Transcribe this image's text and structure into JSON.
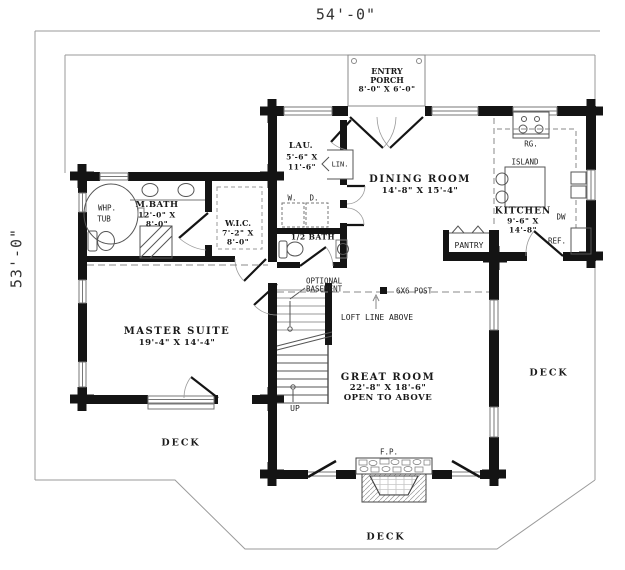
{
  "dimensions": {
    "top": "54'-0\"",
    "left": "53'-0\""
  },
  "rooms": {
    "entry_porch": {
      "line1": "ENTRY",
      "line2": "PORCH",
      "size": "8'-0\" X 6'-0\""
    },
    "laundry": {
      "name": "LAU.",
      "size1": "5'-6\" X",
      "size2": "11'-6\""
    },
    "dining_room": {
      "name": "DINING ROOM",
      "size": "14'-8\" X 15'-4\""
    },
    "kitchen": {
      "name": "KITCHEN",
      "size1": "9'-6\" X",
      "size2": "14'-8\""
    },
    "master_bath": {
      "name": "M.BATH",
      "size1": "12'-0\" X",
      "size2": "8'-0\""
    },
    "wic": {
      "name": "W.I.C.",
      "size1": "7'-2\" X",
      "size2": "8'-0\""
    },
    "half_bath": {
      "name": "1/2 BATH"
    },
    "master_suite": {
      "name": "MASTER SUITE",
      "size": "19'-4\" X 14'-4\""
    },
    "great_room": {
      "name": "GREAT ROOM",
      "size": "22'-8\" X 18'-6\"",
      "note": "OPEN TO ABOVE"
    },
    "pantry": {
      "name": "PANTRY"
    },
    "decks": {
      "left": "DECK",
      "right": "DECK",
      "bottom": "DECK"
    }
  },
  "annotations": {
    "optional_basement1": "OPTIONAL",
    "optional_basement2": "BASEMENT",
    "post": "6X6 POST",
    "loft_line": "LOFT LINE ABOVE",
    "up": "UP",
    "whirlpool1": "WHP.",
    "whirlpool2": "TUB",
    "linen": "LIN.",
    "washer": "W.",
    "dryer": "D.",
    "range": "RG.",
    "island": "ISLAND",
    "dishwasher": "DW",
    "refrigerator": "REF.",
    "fireplace": "F.P."
  },
  "colors": {
    "wall": "#141414",
    "thin_line": "#777777",
    "deck_line": "#9a9a9a",
    "text": "#1a1a1a"
  }
}
